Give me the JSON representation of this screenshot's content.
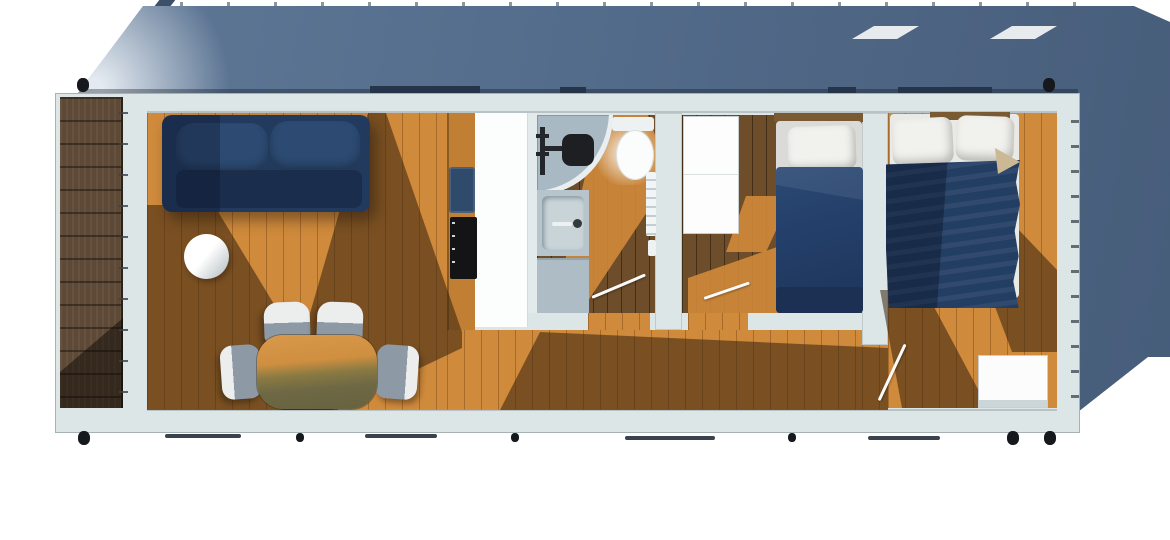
{
  "scene": {
    "description": "Top-down 3D architectural rendering of a rectangular tiny-house / mobile-home floor plan with sunlight shadows",
    "view": "plan view from above",
    "visible_text": "",
    "rooms": [
      {
        "name": "porch-deck",
        "position": "far left, dark wood decking"
      },
      {
        "name": "living-dining-area",
        "position": "left third, sofa + dining set"
      },
      {
        "name": "kitchen",
        "position": "center-left galley counter"
      },
      {
        "name": "bathroom",
        "position": "center, corner shower / toilet / basin / cabinet"
      },
      {
        "name": "single-bedroom",
        "position": "center-right, wardrobe + single bed"
      },
      {
        "name": "double-bedroom",
        "position": "right end, double bed + dresser"
      },
      {
        "name": "hallway",
        "position": "along bottom of bathroom and single bedroom"
      }
    ],
    "inventory": [
      {
        "name": "roof-canopy",
        "count": 1
      },
      {
        "name": "roof-skylight",
        "count": 2
      },
      {
        "name": "corner-casting-knob",
        "count": 5
      },
      {
        "name": "foundation-dot",
        "count": 3
      },
      {
        "name": "base-rail",
        "count": 4
      },
      {
        "name": "sofa",
        "count": 1
      },
      {
        "name": "round-side-table",
        "count": 1
      },
      {
        "name": "dining-table",
        "count": 1
      },
      {
        "name": "dining-chair",
        "count": 4
      },
      {
        "name": "kitchen-sink",
        "count": 1
      },
      {
        "name": "induction-cooktop",
        "count": 1
      },
      {
        "name": "corner-shower",
        "count": 1
      },
      {
        "name": "toilet",
        "count": 1
      },
      {
        "name": "washbasin",
        "count": 1
      },
      {
        "name": "bathroom-cabinet",
        "count": 1
      },
      {
        "name": "towel-radiator",
        "count": 1
      },
      {
        "name": "wardrobe",
        "count": 1
      },
      {
        "name": "single-bed",
        "count": 1
      },
      {
        "name": "double-bed",
        "count": 1
      },
      {
        "name": "dresser",
        "count": 1
      },
      {
        "name": "door-swing-line",
        "count": 3
      }
    ]
  },
  "palette": {
    "wall": "#dde6e7",
    "wall-edge": "#a7b2b5",
    "roof-light": "#8799ae",
    "roof-mid": "#556e8d",
    "roof-dark": "#465d7a",
    "skylight": "#e7ebee",
    "chimney": "#3d5068",
    "window-bar": "#26344a",
    "knob": "#15181c",
    "rail": "#39434d",
    "deck": "#5e4936",
    "floor-lit": "#cf8a3c",
    "floor-dark": "#6d4d2a",
    "shade": "rgba(52,33,13,0.55)",
    "lit-overlay": "rgba(208,138,58,0.9)",
    "sofa-navy": "#223a5d",
    "cushion-navy": "#2c4a72",
    "duvet-navy": "#233e63",
    "footboard-navy": "#1b3052",
    "headboard-wood": "#7a5a33",
    "pillow-white": "#f1f1ee",
    "mattress-white": "#e9e9e6",
    "sheet-fold": "#cbb894",
    "counter-wood": "#c07f33",
    "countertop-white": "#fcfdfd",
    "sink-navy": "#2f4a6b",
    "cooktop-black": "#141417",
    "shower-tray": "#a9b9c3",
    "fixture-gray": "#b7c4cb",
    "fixture-dark": "#23272c",
    "table-top": "#d9984a",
    "table-shade": "#6e6845",
    "chair-gray": "#8d9aa6",
    "chair-white": "#eceded",
    "furniture-white": "#fcfcfc"
  }
}
